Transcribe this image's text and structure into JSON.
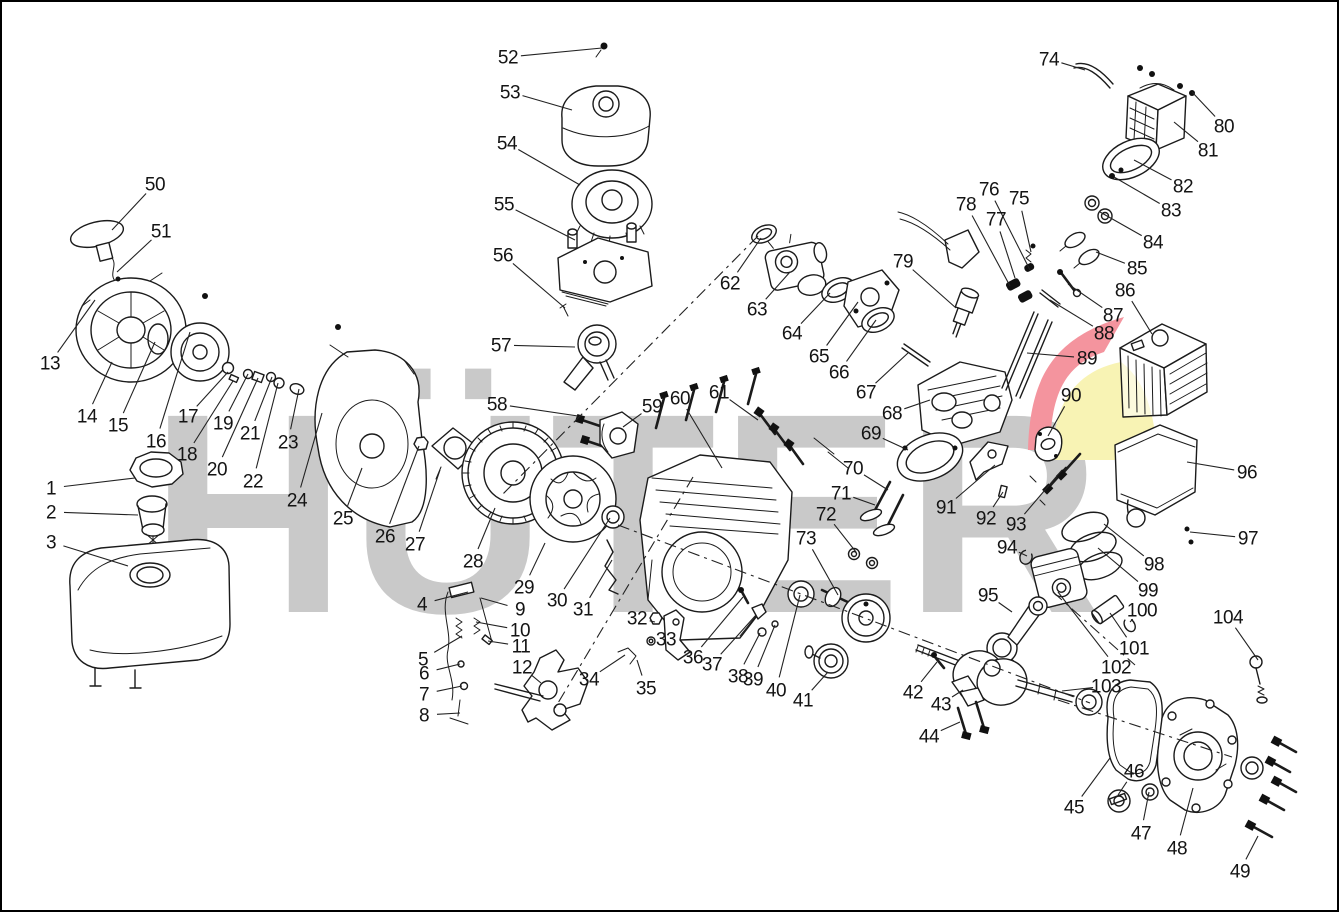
{
  "page": {
    "width": 1339,
    "height": 912,
    "background": "#ffffff",
    "border_color": "#000000"
  },
  "watermark": {
    "text": "HÜTER",
    "color": "#c9c9c9",
    "logo_red": "#f4949e",
    "logo_yellow": "#f8f3b4"
  },
  "diagram": {
    "type": "exploded-parts-diagram",
    "subject": "gasoline-engine",
    "part_count": 104
  },
  "axis_lines": [
    {
      "x1": 758,
      "y1": 236,
      "x2": 500,
      "y2": 497
    },
    {
      "x1": 693,
      "y1": 477,
      "x2": 555,
      "y2": 708
    },
    {
      "x1": 618,
      "y1": 525,
      "x2": 1090,
      "y2": 703
    },
    {
      "x1": 1058,
      "y1": 700,
      "x2": 1232,
      "y2": 757
    },
    {
      "x1": 1053,
      "y1": 592,
      "x2": 1135,
      "y2": 665
    }
  ],
  "labels": [
    {
      "n": "1",
      "x": 51,
      "y": 488,
      "tx": 135,
      "ty": 478
    },
    {
      "n": "2",
      "x": 51,
      "y": 512,
      "tx": 138,
      "ty": 515
    },
    {
      "n": "3",
      "x": 51,
      "y": 542,
      "tx": 128,
      "ty": 566
    },
    {
      "n": "4",
      "x": 422,
      "y": 604,
      "tx": 468,
      "ty": 592
    },
    {
      "n": "5",
      "x": 423,
      "y": 659,
      "tx": 462,
      "ty": 636
    },
    {
      "n": "6",
      "x": 424,
      "y": 673,
      "tx": 460,
      "ty": 664
    },
    {
      "n": "7",
      "x": 424,
      "y": 694,
      "tx": 462,
      "ty": 686
    },
    {
      "n": "8",
      "x": 424,
      "y": 715,
      "tx": 460,
      "ty": 713
    },
    {
      "n": "9",
      "x": 520,
      "y": 609,
      "tx": 481,
      "ty": 598
    },
    {
      "n": "10",
      "x": 520,
      "y": 630,
      "tx": 476,
      "ty": 622
    },
    {
      "n": "11",
      "x": 521,
      "y": 646,
      "tx": 488,
      "ty": 641
    },
    {
      "n": "12",
      "x": 522,
      "y": 667,
      "tx": 541,
      "ty": 683
    },
    {
      "n": "13",
      "x": 50,
      "y": 363,
      "tx": 95,
      "ty": 300
    },
    {
      "n": "14",
      "x": 87,
      "y": 416,
      "tx": 112,
      "ty": 362
    },
    {
      "n": "15",
      "x": 118,
      "y": 425,
      "tx": 155,
      "ty": 342
    },
    {
      "n": "16",
      "x": 156,
      "y": 441,
      "tx": 190,
      "ty": 332
    },
    {
      "n": "17",
      "x": 188,
      "y": 416,
      "tx": 228,
      "ty": 372
    },
    {
      "n": "18",
      "x": 187,
      "y": 454,
      "tx": 233,
      "ty": 381
    },
    {
      "n": "19",
      "x": 223,
      "y": 423,
      "tx": 248,
      "ty": 374
    },
    {
      "n": "20",
      "x": 217,
      "y": 469,
      "tx": 258,
      "ty": 378
    },
    {
      "n": "21",
      "x": 250,
      "y": 433,
      "tx": 272,
      "ty": 377
    },
    {
      "n": "22",
      "x": 253,
      "y": 481,
      "tx": 278,
      "ty": 383
    },
    {
      "n": "23",
      "x": 288,
      "y": 442,
      "tx": 299,
      "ty": 389
    },
    {
      "n": "24",
      "x": 297,
      "y": 500,
      "tx": 322,
      "ty": 413
    },
    {
      "n": "25",
      "x": 343,
      "y": 518,
      "tx": 362,
      "ty": 468
    },
    {
      "n": "26",
      "x": 385,
      "y": 536,
      "tx": 419,
      "ty": 446
    },
    {
      "n": "27",
      "x": 415,
      "y": 544,
      "tx": 440,
      "ty": 470
    },
    {
      "n": "28",
      "x": 473,
      "y": 561,
      "tx": 495,
      "ty": 508
    },
    {
      "n": "29",
      "x": 524,
      "y": 587,
      "tx": 545,
      "ty": 543
    },
    {
      "n": "30",
      "x": 557,
      "y": 600,
      "tx": 610,
      "ty": 518
    },
    {
      "n": "31",
      "x": 583,
      "y": 609,
      "tx": 612,
      "ty": 560
    },
    {
      "n": "32",
      "x": 637,
      "y": 618,
      "tx": 655,
      "ty": 622
    },
    {
      "n": "33",
      "x": 666,
      "y": 639,
      "tx": 652,
      "ty": 641
    },
    {
      "n": "34",
      "x": 589,
      "y": 679,
      "tx": 625,
      "ty": 655
    },
    {
      "n": "35",
      "x": 646,
      "y": 688,
      "tx": 637,
      "ty": 660
    },
    {
      "n": "36",
      "x": 693,
      "y": 657,
      "tx": 743,
      "ty": 597
    },
    {
      "n": "37",
      "x": 712,
      "y": 664,
      "tx": 756,
      "ty": 615
    },
    {
      "n": "38",
      "x": 738,
      "y": 676,
      "tx": 760,
      "ty": 633
    },
    {
      "n": "39",
      "x": 753,
      "y": 679,
      "tx": 775,
      "ty": 625
    },
    {
      "n": "40",
      "x": 776,
      "y": 690,
      "tx": 800,
      "ty": 595
    },
    {
      "n": "41",
      "x": 803,
      "y": 700,
      "tx": 828,
      "ty": 672
    },
    {
      "n": "42",
      "x": 913,
      "y": 692,
      "tx": 937,
      "ty": 662
    },
    {
      "n": "43",
      "x": 941,
      "y": 704,
      "tx": 963,
      "ty": 690
    },
    {
      "n": "44",
      "x": 929,
      "y": 736,
      "tx": 960,
      "ty": 722
    },
    {
      "n": "45",
      "x": 1074,
      "y": 807,
      "tx": 1110,
      "ty": 758
    },
    {
      "n": "46",
      "x": 1134,
      "y": 771,
      "tx": 1118,
      "ty": 795
    },
    {
      "n": "47",
      "x": 1141,
      "y": 833,
      "tx": 1149,
      "ty": 792
    },
    {
      "n": "48",
      "x": 1177,
      "y": 848,
      "tx": 1193,
      "ty": 788
    },
    {
      "n": "49",
      "x": 1240,
      "y": 871,
      "tx": 1258,
      "ty": 836
    },
    {
      "n": "50",
      "x": 155,
      "y": 184,
      "tx": 112,
      "ty": 230
    },
    {
      "n": "51",
      "x": 161,
      "y": 231,
      "tx": 117,
      "ty": 272
    },
    {
      "n": "52",
      "x": 508,
      "y": 57,
      "tx": 602,
      "ty": 48
    },
    {
      "n": "53",
      "x": 510,
      "y": 92,
      "tx": 572,
      "ty": 110
    },
    {
      "n": "54",
      "x": 507,
      "y": 143,
      "tx": 580,
      "ty": 185
    },
    {
      "n": "55",
      "x": 504,
      "y": 204,
      "tx": 575,
      "ty": 240
    },
    {
      "n": "56",
      "x": 503,
      "y": 255,
      "tx": 565,
      "ty": 308
    },
    {
      "n": "57",
      "x": 501,
      "y": 345,
      "tx": 575,
      "ty": 347
    },
    {
      "n": "58",
      "x": 497,
      "y": 404,
      "tx": 578,
      "ty": 416
    },
    {
      "n": "59",
      "x": 652,
      "y": 406,
      "tx": 623,
      "ty": 427
    },
    {
      "n": "60",
      "x": 680,
      "y": 398,
      "tx": 722,
      "ty": 468
    },
    {
      "n": "61",
      "x": 719,
      "y": 392,
      "tx": 758,
      "ty": 420
    },
    {
      "n": "62",
      "x": 730,
      "y": 283,
      "tx": 761,
      "ty": 238
    },
    {
      "n": "63",
      "x": 757,
      "y": 309,
      "tx": 790,
      "ty": 272
    },
    {
      "n": "64",
      "x": 792,
      "y": 333,
      "tx": 830,
      "ty": 293
    },
    {
      "n": "65",
      "x": 819,
      "y": 356,
      "tx": 858,
      "ty": 302
    },
    {
      "n": "66",
      "x": 839,
      "y": 372,
      "tx": 876,
      "ty": 320
    },
    {
      "n": "67",
      "x": 866,
      "y": 392,
      "tx": 908,
      "ty": 353
    },
    {
      "n": "68",
      "x": 892,
      "y": 413,
      "tx": 930,
      "ty": 400
    },
    {
      "n": "69",
      "x": 871,
      "y": 433,
      "tx": 908,
      "ty": 450
    },
    {
      "n": "70",
      "x": 853,
      "y": 468,
      "tx": 888,
      "ty": 490
    },
    {
      "n": "71",
      "x": 841,
      "y": 493,
      "tx": 875,
      "ty": 505
    },
    {
      "n": "72",
      "x": 826,
      "y": 514,
      "tx": 856,
      "ty": 552
    },
    {
      "n": "73",
      "x": 806,
      "y": 538,
      "tx": 838,
      "ty": 595
    },
    {
      "n": "74",
      "x": 1049,
      "y": 59,
      "tx": 1085,
      "ty": 70
    },
    {
      "n": "75",
      "x": 1019,
      "y": 198,
      "tx": 1031,
      "ty": 252
    },
    {
      "n": "76",
      "x": 989,
      "y": 189,
      "tx": 1030,
      "ty": 270
    },
    {
      "n": "77",
      "x": 996,
      "y": 219,
      "tx": 1015,
      "ty": 278
    },
    {
      "n": "78",
      "x": 966,
      "y": 204,
      "tx": 1010,
      "ty": 286
    },
    {
      "n": "79",
      "x": 903,
      "y": 261,
      "tx": 956,
      "ty": 308
    },
    {
      "n": "80",
      "x": 1224,
      "y": 126,
      "tx": 1192,
      "ty": 92
    },
    {
      "n": "81",
      "x": 1208,
      "y": 150,
      "tx": 1174,
      "ty": 122
    },
    {
      "n": "82",
      "x": 1183,
      "y": 186,
      "tx": 1134,
      "ty": 160
    },
    {
      "n": "83",
      "x": 1171,
      "y": 210,
      "tx": 1114,
      "ty": 177
    },
    {
      "n": "84",
      "x": 1153,
      "y": 242,
      "tx": 1100,
      "ty": 212
    },
    {
      "n": "85",
      "x": 1137,
      "y": 268,
      "tx": 1096,
      "ty": 252
    },
    {
      "n": "86",
      "x": 1125,
      "y": 290,
      "tx": 1152,
      "ty": 334
    },
    {
      "n": "87",
      "x": 1113,
      "y": 315,
      "tx": 1068,
      "ty": 284
    },
    {
      "n": "88",
      "x": 1104,
      "y": 333,
      "tx": 1050,
      "ty": 300
    },
    {
      "n": "89",
      "x": 1087,
      "y": 358,
      "tx": 1027,
      "ty": 353
    },
    {
      "n": "90",
      "x": 1071,
      "y": 395,
      "tx": 1048,
      "ty": 436
    },
    {
      "n": "91",
      "x": 946,
      "y": 507,
      "tx": 995,
      "ty": 465
    },
    {
      "n": "92",
      "x": 986,
      "y": 518,
      "tx": 1003,
      "ty": 492
    },
    {
      "n": "93",
      "x": 1016,
      "y": 524,
      "tx": 1062,
      "ty": 470
    },
    {
      "n": "94",
      "x": 1007,
      "y": 547,
      "tx": 1027,
      "ty": 556
    },
    {
      "n": "95",
      "x": 988,
      "y": 595,
      "tx": 1012,
      "ty": 612
    },
    {
      "n": "96",
      "x": 1247,
      "y": 472,
      "tx": 1187,
      "ty": 462
    },
    {
      "n": "97",
      "x": 1248,
      "y": 538,
      "tx": 1190,
      "ty": 532
    },
    {
      "n": "98",
      "x": 1154,
      "y": 564,
      "tx": 1104,
      "ty": 524
    },
    {
      "n": "99",
      "x": 1148,
      "y": 590,
      "tx": 1098,
      "ty": 548
    },
    {
      "n": "100",
      "x": 1142,
      "y": 610,
      "tx": 1130,
      "ty": 622
    },
    {
      "n": "101",
      "x": 1134,
      "y": 648,
      "tx": 1110,
      "ty": 613
    },
    {
      "n": "102",
      "x": 1116,
      "y": 667,
      "tx": 1058,
      "ty": 592
    },
    {
      "n": "103",
      "x": 1106,
      "y": 686,
      "tx": 1062,
      "ty": 691
    },
    {
      "n": "104",
      "x": 1228,
      "y": 617,
      "tx": 1258,
      "ty": 660
    }
  ]
}
